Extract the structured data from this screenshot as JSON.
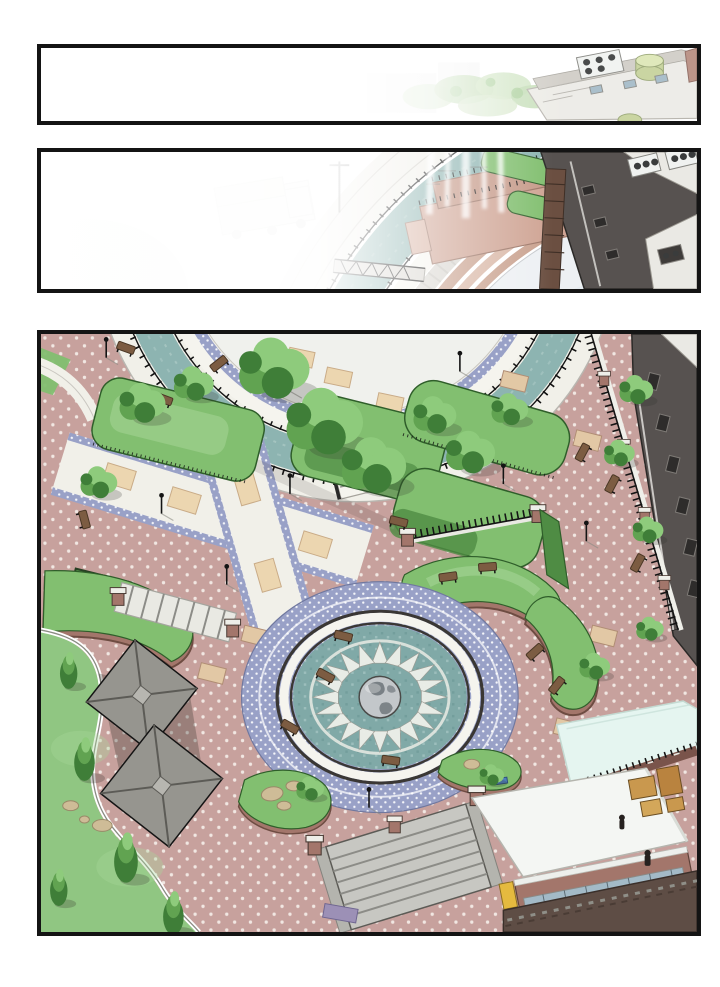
{
  "page": {
    "kind": "comic page of architectural park renderings",
    "panel_count": 3
  },
  "panels": [
    {
      "id": "panel-1",
      "alt": "Thin aerial panel fading to white; at right a building rooftop with air-conditioning unit, green water tank, parapet and windows; faint treetops in the middle.",
      "elements": [
        "white fade",
        "treetops",
        "rooftop parapet",
        "ac-unit",
        "green water tank",
        "brick edge"
      ]
    },
    {
      "id": "panel-2",
      "alt": "Aerial view of a circular amphitheater plaza: concentric seating rings, teal water canal, tan stage with railings, fountain jets, faded truck at upper left, faded lawn circle at lower left, dark office building with rooftop AC units at right; left side fades to white.",
      "elements": [
        "amphitheater rings",
        "teal canal",
        "stage",
        "fountain jets",
        "truck",
        "lawn circle",
        "office building",
        "ac-units",
        "bridge railing"
      ]
    },
    {
      "id": "panel-3",
      "alt": "Large aerial view of the park plaza: circular globe fountain with triangular jet ring, blue dotted ring pavement, crescent grass berms with brick walls, pink dotted paving with tan tiles, white walkways with blue dotted borders, garden beds with trees, iron fences, two gray pavilions, grand staircase with brick piers, kiosk with white roof and window band, light cyan event tent, wooden crates, lawns with pines and rocks, dark building facade at right.",
      "elements": [
        "canal ring with bridge",
        "garden beds",
        "iron fences",
        "globe fountain",
        "jet ring",
        "grass berms",
        "pavilions",
        "grand stairs",
        "kiosk",
        "event tent",
        "crates",
        "lawn",
        "pines",
        "rocks",
        "benches",
        "lamp posts",
        "building facade",
        "perimeter walls"
      ]
    }
  ],
  "palette": {
    "ink": "#141414",
    "paper": "#ffffff",
    "paving": "#c7a19d",
    "pavingDot": "#f1e7e2",
    "tanTile": "#e2c8a5",
    "tanEdge": "#b08d74",
    "pathWhite": "#f1f0e9",
    "band": "#99a1c7",
    "canal": "#8db4b1",
    "basin": "#80a9a7",
    "ringWhite": "#f5f4ee",
    "rim": "#3a3734",
    "grass": "#82bf70",
    "grassHi": "#a9d79a",
    "hedge": "#4f8c44",
    "lawn": "#90c682",
    "brick": "#a3766b",
    "brickDk": "#7a544b",
    "roof": "#96958f",
    "roofDk": "#5c5b56",
    "bldg": "#575250",
    "bldgHi": "#eae9e4",
    "win": "#2e2c2b",
    "winBlue": "#a3bac7",
    "ac": "#f0f2f0",
    "fan": "#3a3c3c",
    "tank": "#c6d29b",
    "tent": "#e5f5f0",
    "stair": "#c7c7c2",
    "stairLn": "#8c8c87",
    "bench": "#7c5c42",
    "benchDk": "#4a3725",
    "rock": "#cebc97",
    "rockDk": "#998968",
    "box": "#c9984e",
    "vend": "#e5ba3f",
    "truck": "#b7c8ae",
    "globe": "#c3c7ca",
    "globeDk": "#71787d",
    "treeHi": "#8ecb7c",
    "treeMid": "#61a351",
    "treeDk": "#3f7e38"
  }
}
